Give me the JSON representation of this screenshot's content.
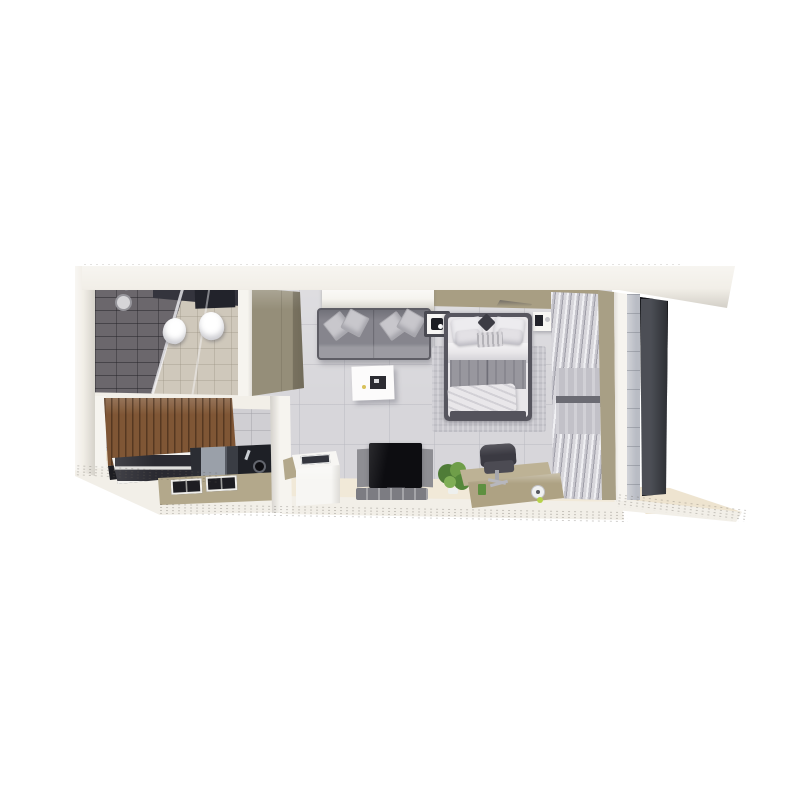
{
  "meta": {
    "description": "3D isometric cutaway rendering of a studio apartment floor plan on a white background",
    "view": "top-down isometric",
    "canvas": {
      "width": 800,
      "height": 800
    }
  },
  "palette": {
    "background": "#ffffff",
    "wall_white": "#f2efe8",
    "wall_bright": "#f6f4ef",
    "slab_beige": "#eee4d0",
    "floor_gray": "#d7d6da",
    "floor_cream": "#f1e9d8",
    "bathroom_tile_dark": "#6b676c",
    "bathroom_floor": "#cfc8bb",
    "bathroom_band_dark": "#34343d",
    "cistern_dark": "#22232b",
    "kitchen_wall_tile": "#d0cfd3",
    "wardrobe_tan": "#958e79",
    "headboard_tan": "#a89e83",
    "wood_brown": "#7f5635",
    "counter_black": "#1d1d22",
    "counter_khaki": "#b3a88b",
    "sofa_gray": "#86858d",
    "pillow_gray": "#c8c7cc",
    "table_white": "#fcfbfb",
    "nightstand_frame": "#4a4a52",
    "rug_gray": "#c8c7cd",
    "bed_frame_dark": "#57565f",
    "bed_white": "#e9e7ea",
    "bed_gray": "#98979e",
    "curtain_mid": "#b4b3bb",
    "window_glass": "#c2c1c8",
    "wall_strip_tan": "#a89f85",
    "wall_strip_gray": "#b9bcc4",
    "balcony_door": "#3e4148",
    "tv_black": "#0d0d11",
    "tv_panel_gray": "#8e8e93",
    "mat_gray": "#7c7c82",
    "washer_white": "#f7f6f3",
    "plant_green_dark": "#4f7c37",
    "plant_green_mid": "#6f9e49",
    "desk_khaki": "#aea283",
    "desk_top_khaki": "#bdb295",
    "chair_dark": "#3b3a42",
    "white": "#ffffff"
  },
  "scene": {
    "unit": "studio apartment",
    "rooms": [
      {
        "name": "bathroom",
        "items": [
          "dark tiled shower wall",
          "shower head",
          "glass shower screen",
          "toilet",
          "wash basin",
          "beige tile floor"
        ]
      },
      {
        "name": "kitchen",
        "items": [
          "wood slat cabinet",
          "black counter band",
          "glass dining table",
          "oven",
          "sink",
          "cooktop burner grates",
          "khaki counter",
          "washing machine"
        ]
      },
      {
        "name": "living area",
        "items": [
          "wardrobe",
          "wall console / air conditioner",
          "two-seat gray sofa",
          "four throw pillows",
          "white coffee table",
          "television",
          "media mat"
        ]
      },
      {
        "name": "sleeping area",
        "items": [
          "double bed with white and gray bedding",
          "left nightstand",
          "right nightstand",
          "area rug",
          "khaki desk",
          "office chair",
          "potted plant",
          "bunched curtains"
        ]
      },
      {
        "name": "balcony",
        "items": [
          "tan wall strip",
          "gray tiled wall strip",
          "dark glass sliding door",
          "floor slab"
        ]
      }
    ]
  }
}
